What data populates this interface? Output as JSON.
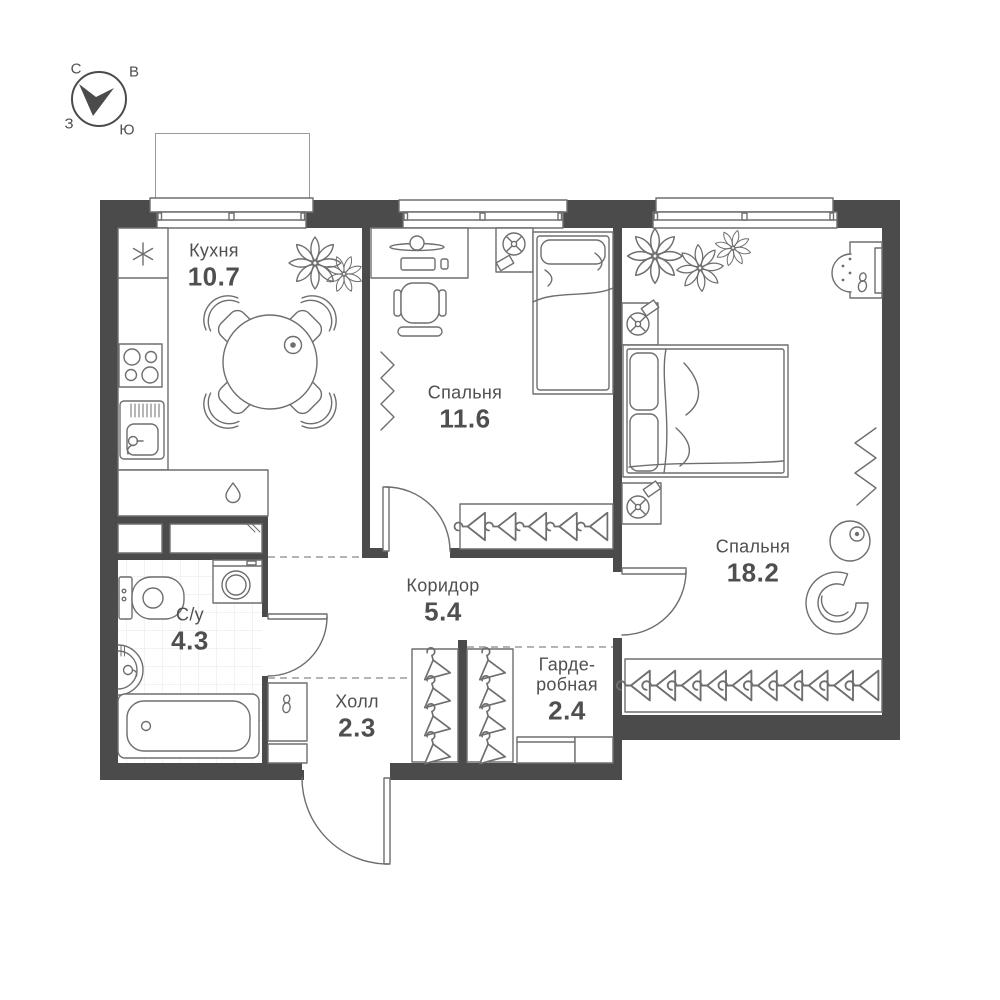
{
  "compass": {
    "north": "С",
    "east": "В",
    "west": "З",
    "south": "Ю"
  },
  "rooms": {
    "kitchen": {
      "label": "Кухня",
      "area": "10.7"
    },
    "bedroom_small": {
      "label": "Спальня",
      "area": "11.6"
    },
    "bedroom_large": {
      "label": "Спальня",
      "area": "18.2"
    },
    "bathroom": {
      "label": "С/у",
      "area": "4.3"
    },
    "corridor": {
      "label": "Коридор",
      "area": "5.4"
    },
    "hall": {
      "label": "Холл",
      "area": "2.3"
    },
    "wardrobe": {
      "label_line1": "Гарде-",
      "label_line2": "робная",
      "area": "2.4"
    }
  },
  "colors": {
    "wall": "#4b4b4b",
    "line": "#6e6e6e",
    "text": "#4f4f4f",
    "tile": "#e4e4e4",
    "dash": "#9b9b9b"
  }
}
